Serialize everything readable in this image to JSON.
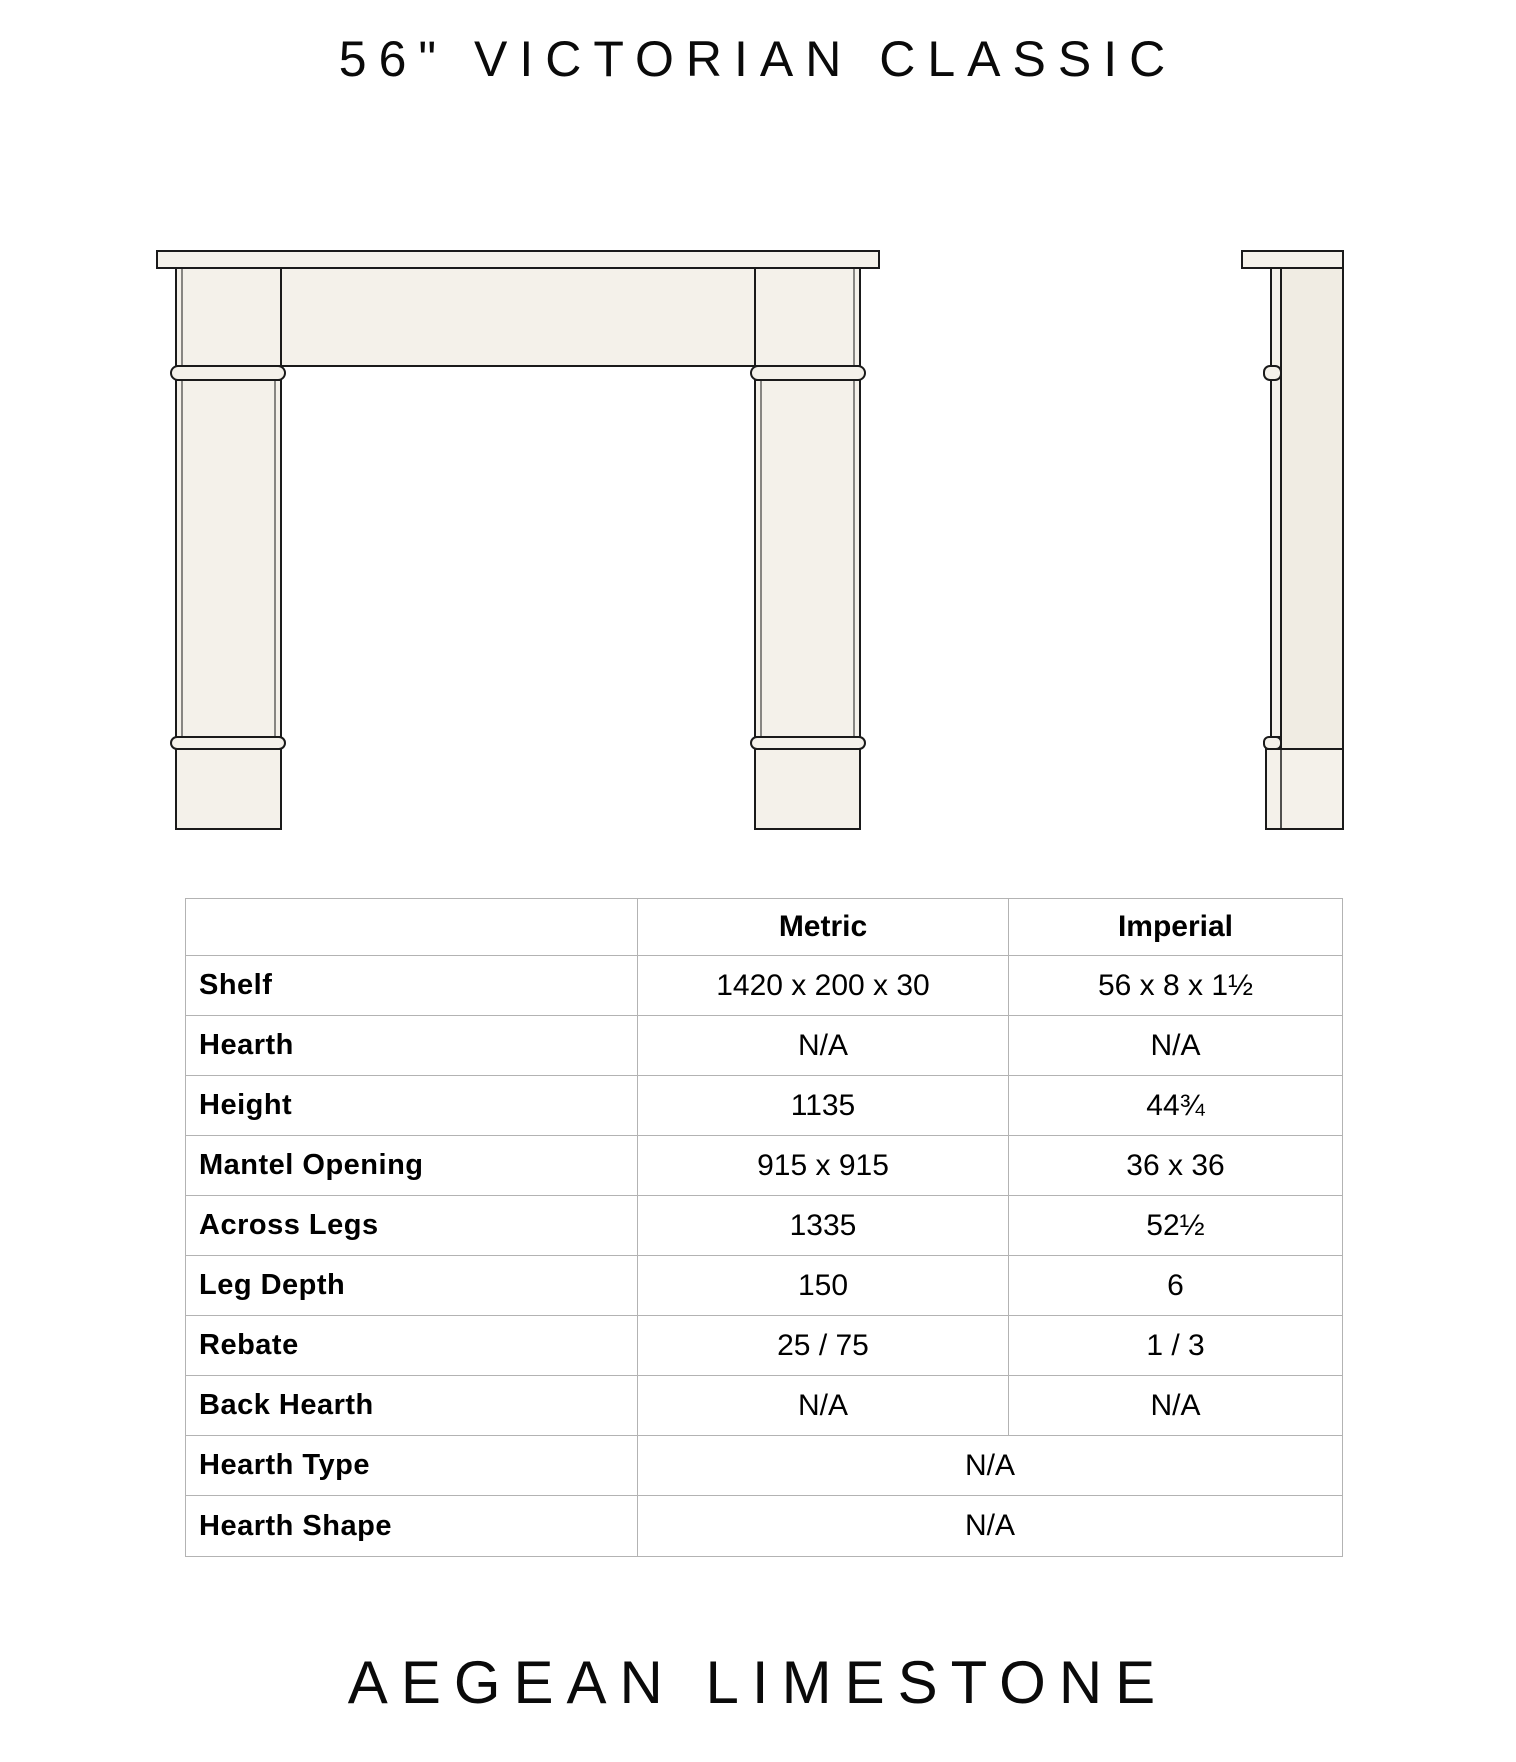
{
  "page": {
    "title": "56\" VICTORIAN CLASSIC",
    "footer": "AEGEAN LIMESTONE"
  },
  "drawing": {
    "front_view_name": "fireplace-mantel-front-elevation",
    "side_view_name": "fireplace-mantel-side-profile",
    "colors": {
      "stone_fill": "#f4f1ea",
      "stone_fill_shade": "#f0ecE3",
      "outline": "#1a1a1a"
    }
  },
  "table": {
    "grid_line_color": "#b3b3b3",
    "columns": [
      "",
      "Metric",
      "Imperial"
    ],
    "rows": [
      {
        "label": "Shelf",
        "metric": "1420 x 200 x 30",
        "imperial": "56 x 8 x 1½"
      },
      {
        "label": "Hearth",
        "metric": "N/A",
        "imperial": "N/A"
      },
      {
        "label": "Height",
        "metric": "1135",
        "imperial": "44¾"
      },
      {
        "label": "Mantel Opening",
        "metric": "915 x 915",
        "imperial": "36 x 36"
      },
      {
        "label": "Across Legs",
        "metric": "1335",
        "imperial": "52½"
      },
      {
        "label": "Leg Depth",
        "metric": "150",
        "imperial": "6"
      },
      {
        "label": "Rebate",
        "metric": "25 / 75",
        "imperial": "1 / 3"
      },
      {
        "label": "Back Hearth",
        "metric": "N/A",
        "imperial": "N/A"
      },
      {
        "label": "Hearth Type",
        "merged": "N/A"
      },
      {
        "label": "Hearth Shape",
        "merged": "N/A"
      }
    ]
  }
}
